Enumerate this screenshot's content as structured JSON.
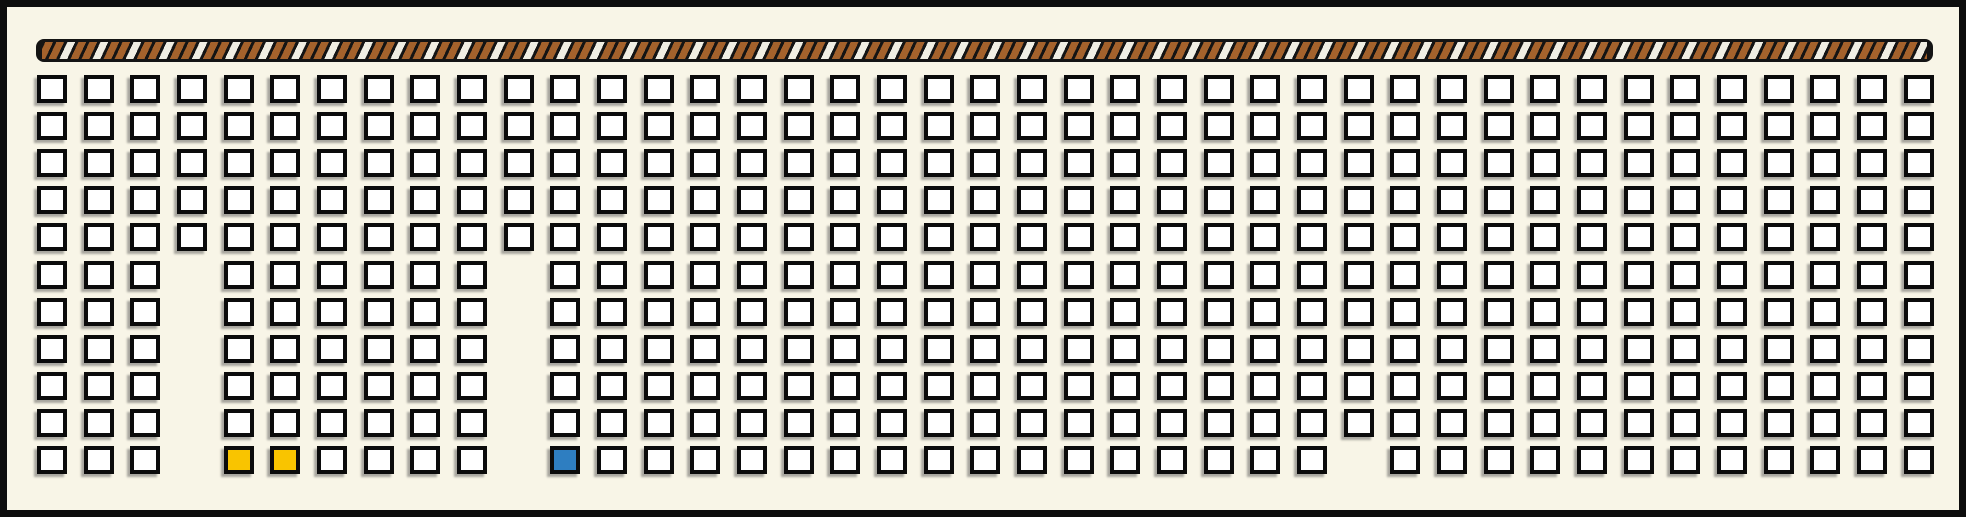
{
  "canvas": {
    "width": 1966,
    "height": 517,
    "background_color": "#f8f5e7",
    "frame_color": "#0d0d0d"
  },
  "rope_bar": {
    "x": 36,
    "y": 39,
    "width": 1897,
    "height": 23,
    "base_color": "#141414",
    "stripe_brown": "#a4622c",
    "stripe_white": "#f0eee3"
  },
  "grid": {
    "columns": 41,
    "rows": 11,
    "origin_x": 37,
    "origin_y": 75,
    "pitch_x": 46.67,
    "pitch_y": 37.1,
    "cell_width": 30,
    "cell_height": 28,
    "cell_fill": "#ffffff",
    "cell_border": "#0b0b0b",
    "missing_cells": [
      {
        "col": 3,
        "rows": [
          5,
          6,
          7,
          8,
          9,
          10
        ]
      },
      {
        "col": 10,
        "rows": [
          5,
          6,
          7,
          8,
          9,
          10
        ]
      },
      {
        "col": 28,
        "rows": [
          10
        ]
      }
    ],
    "highlighted_cells": [
      {
        "col": 4,
        "row": 10,
        "color": "#f9c400",
        "name": "seat-cell-selected-yellow"
      },
      {
        "col": 5,
        "row": 10,
        "color": "#f9c400",
        "name": "seat-cell-selected-yellow"
      },
      {
        "col": 11,
        "row": 10,
        "color": "#2e7ec1",
        "name": "seat-cell-selected-blue"
      }
    ]
  }
}
